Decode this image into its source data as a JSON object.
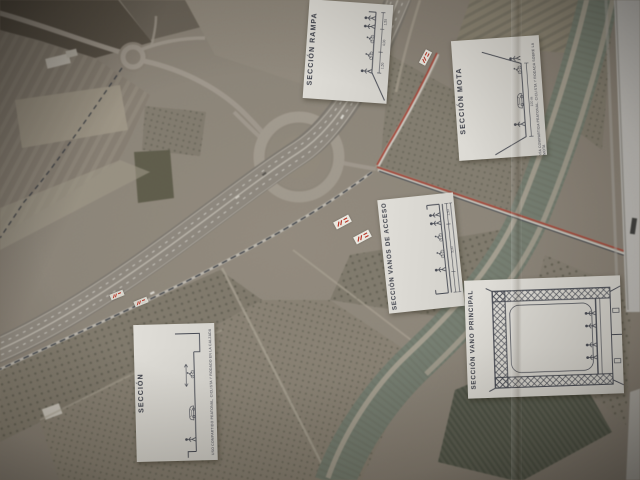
{
  "insets": [
    {
      "id": "rampa",
      "title": "SECCIÓN RAMPA",
      "dims": [
        "1,50",
        "4,00",
        "1,50"
      ]
    },
    {
      "id": "mota",
      "title": "SECCIÓN MOTA",
      "dim": "100 m",
      "caption": "VÍA COMPARTIDA PEATONAL, CICLISTA Y RODADA SOBRE LA MOTA"
    },
    {
      "id": "acceso",
      "title": "SECCIÓN VANOS DE ACCESO",
      "dims": [
        "1,50",
        "5,00"
      ]
    },
    {
      "id": "principal",
      "title": "SECCIÓN VANO PRINCIPAL"
    },
    {
      "id": "seccion",
      "title": "SECCIÓN",
      "caption": "USO COMPARTIDO PEATONAL, CICLISTA Y RODADO EN LA CALZADA"
    }
  ],
  "colors": {
    "paper": "#d9d7d1",
    "ink": "#474a53",
    "route_red": "#bf3a28",
    "route_dark": "#2e333b",
    "river": "#75806f",
    "field": "#8b8172",
    "road": "#a59b8c"
  }
}
